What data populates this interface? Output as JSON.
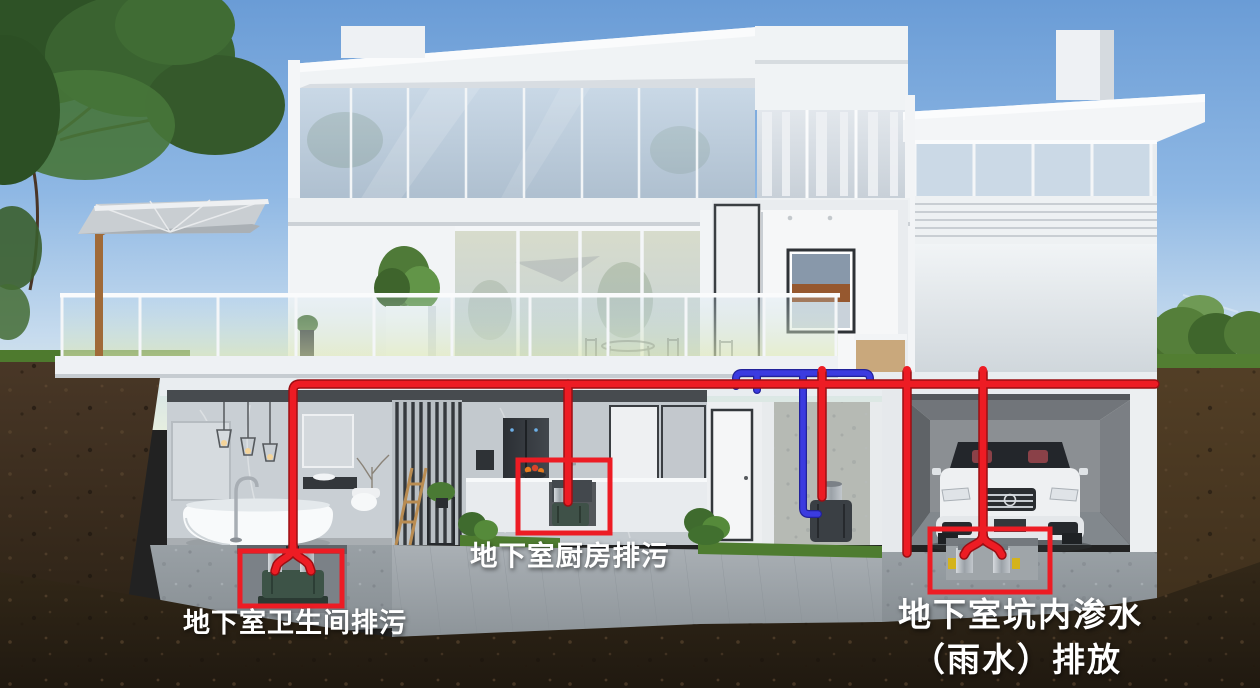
{
  "scene": {
    "labels": {
      "bathroom": "地下室卫生间排污",
      "kitchen": "地下室厨房排污",
      "pit_line1": "地下室坑内渗水",
      "pit_line2": "（雨水）排放"
    },
    "colors": {
      "sewage_pipe": "#ed1c24",
      "drain_pipe": "#3b3be0",
      "annotation_box": "#ed1c24",
      "label_text": "#ffffff"
    }
  }
}
